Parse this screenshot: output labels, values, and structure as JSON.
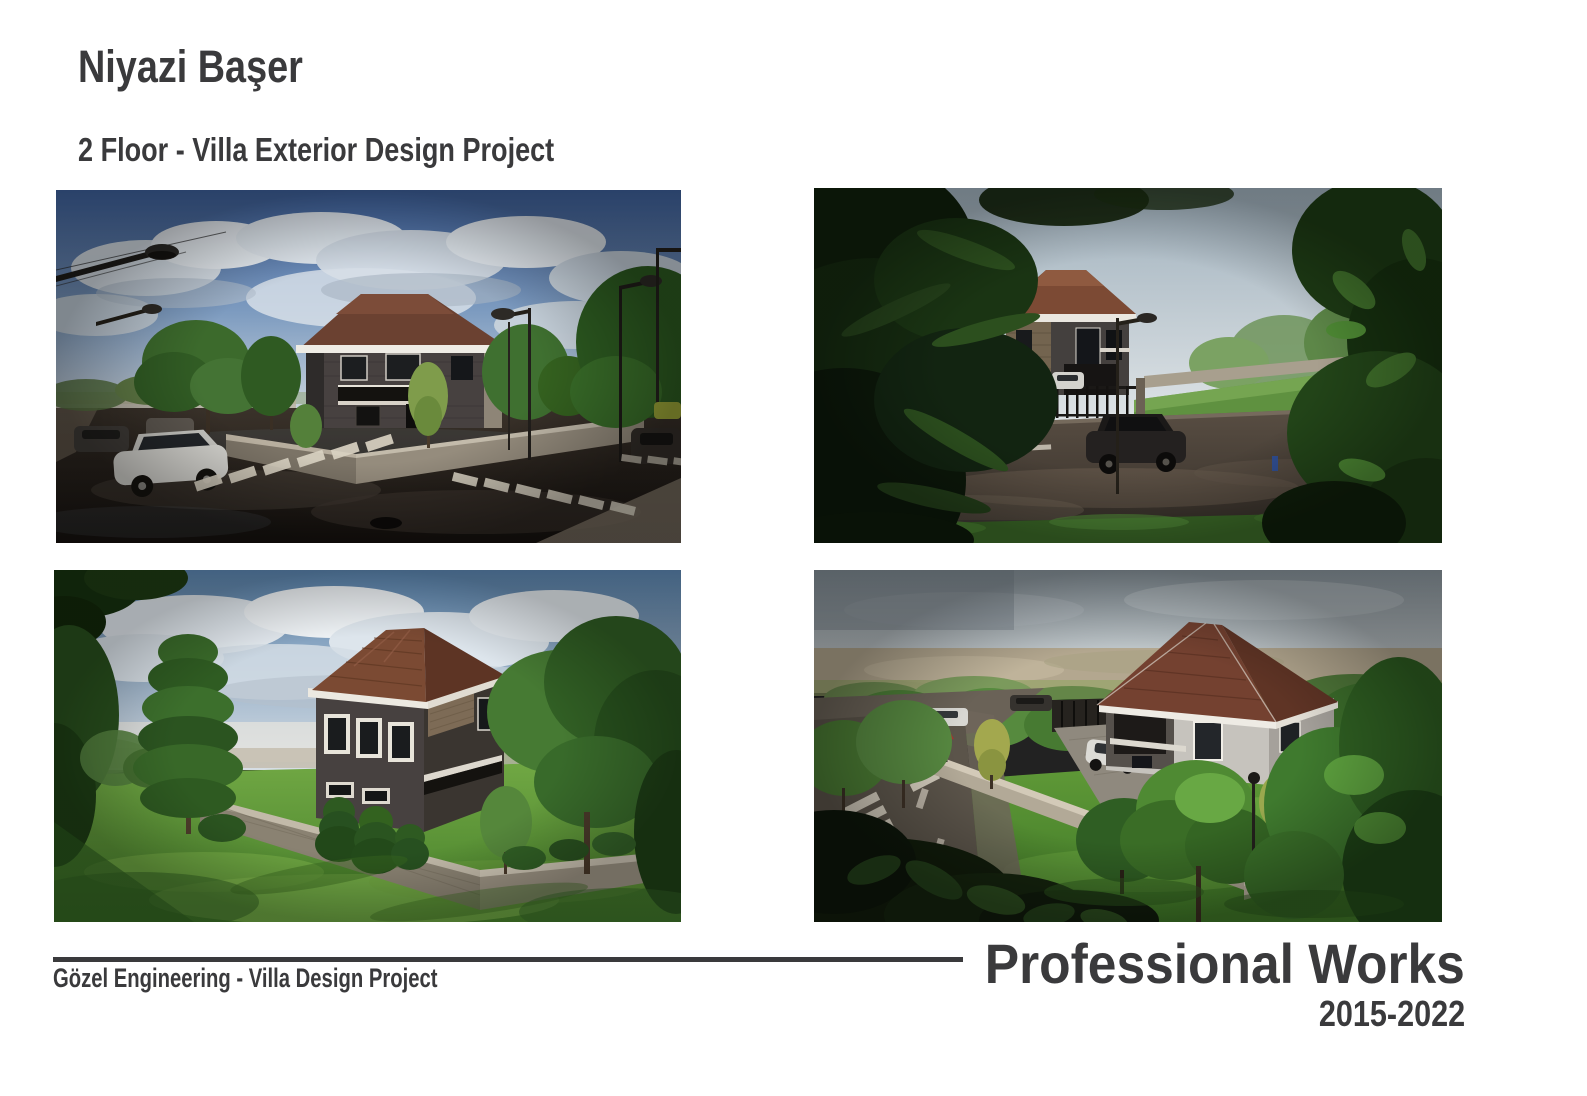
{
  "header": {
    "author": "Niyazi Başer",
    "project": "2 Floor - Villa Exterior Design Project"
  },
  "gallery": {
    "images": [
      {
        "id": "street-view",
        "description": "Street-level render of the two-floor villa: wet asphalt road with crosswalks, parked cars, street lamps, garden wall and trees under a blue cloudy sky"
      },
      {
        "id": "framed-view",
        "description": "Villa with brown hip roof and stone facade seen through dark pine branches and leaves, dark car parked on the wet street in front of the iron fence"
      },
      {
        "id": "garden-view",
        "description": "Garden render: bright green lawn, stone boundary wall, dark grey two-floor villa with white framed windows and brown shingle roof, tall pines and trees"
      },
      {
        "id": "aerial-view",
        "description": "Aerial render of the villa plot: brown hip roof, light walls, paved driveway with white car, lawn with trees, boundary wall, street corner with crosswalks"
      }
    ]
  },
  "footer": {
    "company": "Gözel Engineering - Villa Design Project",
    "works": "Professional Works",
    "years": "2015-2022"
  },
  "colors": {
    "text": "#3a3a3c",
    "divider": "#3a3a3c",
    "background": "#ffffff"
  }
}
